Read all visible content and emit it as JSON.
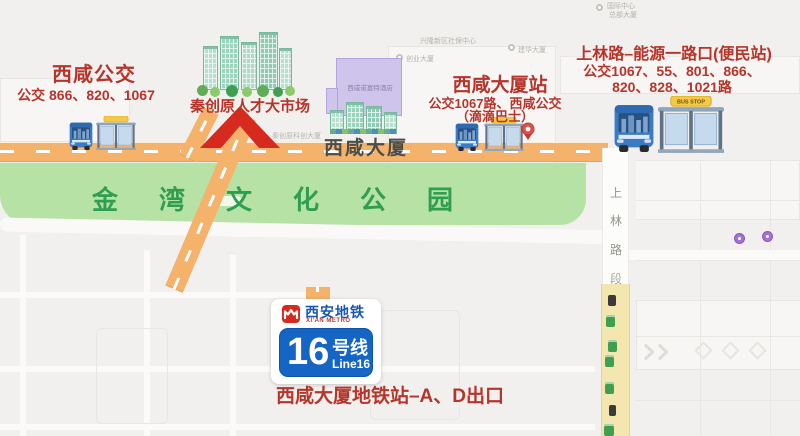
{
  "colors": {
    "accent_red": "#b5352b",
    "arrow_red": "#d62a1e",
    "metro_blue": "#1566c4",
    "metro_brand_blue": "#1a55ae",
    "park_green": "#b7e2a6",
    "park_text_green": "#2f9e50",
    "road_orange": "#f4b26b",
    "road_yellow": "#f3e7af"
  },
  "park": {
    "name": "金湾文化公园"
  },
  "stops": {
    "left": {
      "title": "西咸公交",
      "line1": "公交 866、820、1067"
    },
    "center": {
      "title": "西咸大厦站",
      "line1": "公交1067路、西咸公交",
      "line2": "（滴滴巴士）"
    },
    "right": {
      "title": "上林路–能源一路口(便民站)",
      "line1": "公交1067、55、801、866、",
      "line2": "820、828、1021路"
    }
  },
  "market": {
    "title": "秦创原人才大市场",
    "map_label": "秦创原科创大厦"
  },
  "buildings": {
    "main": "西咸大厦",
    "hotel": "西咸诺富特酒店"
  },
  "metro": {
    "brand_cn": "西安地铁",
    "brand_en": "XI'AN METRO",
    "line_number": "16",
    "line_cn": "号线",
    "line_en": "Line16",
    "exit_note": "西咸大厦地铁站–A、D出口"
  },
  "road": {
    "vertical_name": [
      "上",
      "林",
      "路",
      "段"
    ],
    "bus_sign": "BUS STOP"
  },
  "bg_labels": [
    {
      "text": "兴隆新区社保中心"
    },
    {
      "text": "创业大厦"
    },
    {
      "text": "建华大厦"
    },
    {
      "text": "国际中心"
    },
    {
      "text": "总部大厦"
    }
  ]
}
